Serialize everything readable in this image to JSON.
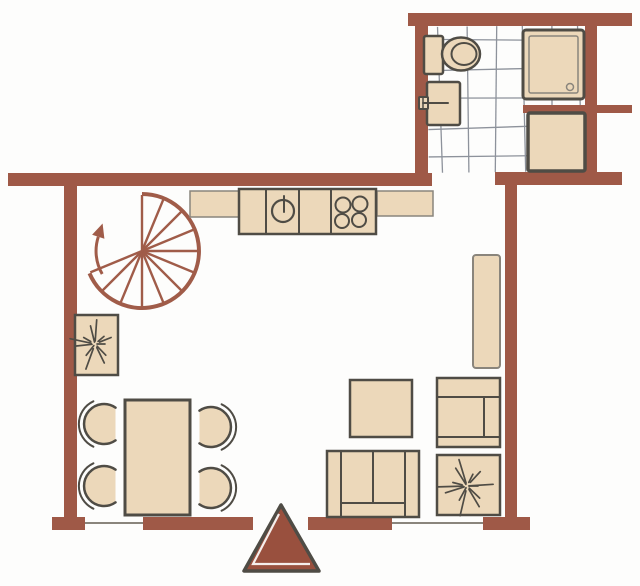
{
  "meta": {
    "title": "apartment-floor-plan",
    "canvas": {
      "width": 640,
      "height": 586
    }
  },
  "palette": {
    "background": "#fdfdfc",
    "wall": "#9f5947",
    "stair": "#a05c49",
    "furniture_fill": "#ecd8ba",
    "outline_dark": "#4f4c45",
    "outline_soft": "#8a857c",
    "grid": "#8d929b",
    "triangle_fill": "#99503e",
    "white": "#ffffff"
  },
  "tile_grid": {
    "region": {
      "x": 428,
      "y": 26,
      "w": 157,
      "h": 146
    },
    "vertical_lines": [
      440,
      468,
      496,
      524,
      552,
      580
    ],
    "horizontal_lines": [
      40,
      69,
      98,
      127,
      156
    ],
    "tilt_deg": -0.7
  },
  "walls": [
    {
      "name": "bathroom-top-wall",
      "x": 408,
      "y": 13,
      "w": 224,
      "h": 13
    },
    {
      "name": "bathroom-left-wall",
      "x": 415,
      "y": 26,
      "w": 13,
      "h": 147
    },
    {
      "name": "bathroom-right-wall",
      "x": 585,
      "y": 26,
      "w": 12,
      "h": 147
    },
    {
      "name": "bathroom-partition-wall",
      "x": 523,
      "y": 105,
      "w": 109,
      "h": 8
    },
    {
      "name": "main-top-wall",
      "x": 8,
      "y": 173,
      "w": 424,
      "h": 13
    },
    {
      "name": "bathroom-bottom-wall",
      "x": 495,
      "y": 172,
      "w": 127,
      "h": 13
    },
    {
      "name": "left-wall",
      "x": 64,
      "y": 186,
      "w": 13,
      "h": 344
    },
    {
      "name": "right-wall",
      "x": 505,
      "y": 185,
      "w": 12,
      "h": 333
    },
    {
      "name": "bottom-wall-left-corner",
      "x": 52,
      "y": 517,
      "w": 33,
      "h": 13
    },
    {
      "name": "bottom-wall-left",
      "x": 143,
      "y": 517,
      "w": 110,
      "h": 13
    },
    {
      "name": "bottom-wall-right",
      "x": 308,
      "y": 517,
      "w": 84,
      "h": 13
    },
    {
      "name": "bottom-wall-right-corner",
      "x": 483,
      "y": 517,
      "w": 47,
      "h": 13
    }
  ],
  "windows": [
    {
      "name": "window-left",
      "x1": 85,
      "y1": 523,
      "x2": 143,
      "y2": 523
    },
    {
      "name": "window-right",
      "x1": 392,
      "y1": 523,
      "x2": 483,
      "y2": 523
    }
  ],
  "stair": {
    "name": "spiral-staircase",
    "cx": 142,
    "cy": 251,
    "r_outer": 57,
    "r_inner": 46,
    "outer_arc": {
      "start_deg": -90,
      "end_deg": 157
    },
    "inner_arc": {
      "start_deg": 150,
      "end_deg": 198
    },
    "spokes": {
      "start_deg": -90,
      "step_deg": 22.5,
      "count": 12
    },
    "arrow": {
      "len": 14,
      "half_width": 6.5
    }
  },
  "shapes": [
    {
      "type": "rect",
      "name": "toilet-tank",
      "x": 424,
      "y": 36,
      "w": 19,
      "h": 38,
      "rx": 2,
      "fill": "furniture_fill",
      "stroke": "outline_dark",
      "sw": 2.5
    },
    {
      "type": "ellipse",
      "name": "toilet-bowl",
      "cx": 461,
      "cy": 54,
      "rx": 19,
      "ry": 16.5,
      "fill": "furniture_fill",
      "stroke": "outline_dark",
      "sw": 2.5
    },
    {
      "type": "ellipse",
      "name": "toilet-bowl-inner",
      "cx": 464,
      "cy": 54,
      "rx": 12.5,
      "ry": 11,
      "fill": "none",
      "stroke": "outline_dark",
      "sw": 2
    },
    {
      "type": "rect",
      "name": "bathroom-sink",
      "x": 427,
      "y": 82,
      "w": 33,
      "h": 43,
      "rx": 2,
      "fill": "furniture_fill",
      "stroke": "outline_dark",
      "sw": 2.5
    },
    {
      "type": "rect",
      "name": "sink-tap-handle",
      "x": 419,
      "y": 97,
      "w": 9,
      "h": 12,
      "rx": 1,
      "fill": "furniture_fill",
      "stroke": "outline_dark",
      "sw": 2
    },
    {
      "type": "line",
      "name": "sink-tap-spout",
      "x1": 423,
      "y1": 103,
      "x2": 448,
      "y2": 103,
      "stroke": "outline_dark",
      "sw": 2
    },
    {
      "type": "line",
      "name": "sink-tap-cross",
      "x1": 423,
      "y1": 97,
      "x2": 423,
      "y2": 109,
      "stroke": "outline_dark",
      "sw": 1.5
    },
    {
      "type": "rect",
      "name": "shower-tray",
      "x": 523,
      "y": 30,
      "w": 61,
      "h": 69,
      "rx": 3,
      "fill": "furniture_fill",
      "stroke": "outline_dark",
      "sw": 3
    },
    {
      "type": "rect",
      "name": "shower-tray-inner",
      "x": 529,
      "y": 36,
      "w": 49,
      "h": 57,
      "rx": 2,
      "fill": "none",
      "stroke": "outline_soft",
      "sw": 1.5
    },
    {
      "type": "circle",
      "name": "shower-drain",
      "cx": 570,
      "cy": 87,
      "r": 3.5,
      "fill": "none",
      "stroke": "outline_soft",
      "sw": 1.5
    },
    {
      "type": "rect",
      "name": "washing-machine",
      "x": 528,
      "y": 113,
      "w": 57,
      "h": 58,
      "rx": 2,
      "fill": "furniture_fill",
      "stroke": "outline_dark",
      "sw": 3.5
    },
    {
      "type": "rect",
      "name": "kitchen-counter-left",
      "x": 190,
      "y": 191,
      "w": 50,
      "h": 26,
      "fill": "furniture_fill",
      "stroke": "outline_soft",
      "sw": 1.5
    },
    {
      "type": "rect",
      "name": "kitchen-counter-right",
      "x": 377,
      "y": 191,
      "w": 56,
      "h": 25,
      "fill": "furniture_fill",
      "stroke": "outline_soft",
      "sw": 1.5
    },
    {
      "type": "rect",
      "name": "kitchen-counter-main",
      "x": 239,
      "y": 189,
      "w": 137,
      "h": 45,
      "fill": "furniture_fill",
      "stroke": "outline_dark",
      "sw": 2.5
    },
    {
      "type": "line",
      "name": "counter-divider-1",
      "x1": 266,
      "y1": 189,
      "x2": 266,
      "y2": 234,
      "stroke": "outline_dark",
      "sw": 2
    },
    {
      "type": "line",
      "name": "counter-divider-2",
      "x1": 299,
      "y1": 189,
      "x2": 299,
      "y2": 234,
      "stroke": "outline_dark",
      "sw": 2
    },
    {
      "type": "line",
      "name": "counter-divider-3",
      "x1": 331,
      "y1": 189,
      "x2": 331,
      "y2": 234,
      "stroke": "outline_dark",
      "sw": 2
    },
    {
      "type": "circle",
      "name": "kitchen-sink-basin",
      "cx": 283,
      "cy": 211,
      "r": 11,
      "fill": "none",
      "stroke": "outline_dark",
      "sw": 2.2
    },
    {
      "type": "line",
      "name": "kitchen-sink-tap",
      "x1": 284,
      "y1": 196,
      "x2": 284,
      "y2": 212,
      "stroke": "outline_dark",
      "sw": 2
    },
    {
      "type": "circle",
      "name": "hob-burner-1",
      "cx": 343,
      "cy": 205,
      "r": 7.5,
      "fill": "none",
      "stroke": "outline_dark",
      "sw": 2
    },
    {
      "type": "circle",
      "name": "hob-burner-2",
      "cx": 360,
      "cy": 204,
      "r": 7.5,
      "fill": "none",
      "stroke": "outline_dark",
      "sw": 2
    },
    {
      "type": "circle",
      "name": "hob-burner-3",
      "cx": 342,
      "cy": 221,
      "r": 7,
      "fill": "none",
      "stroke": "outline_dark",
      "sw": 2
    },
    {
      "type": "circle",
      "name": "hob-burner-4",
      "cx": 359,
      "cy": 220,
      "r": 7,
      "fill": "none",
      "stroke": "outline_dark",
      "sw": 2
    },
    {
      "type": "rect",
      "name": "wall-shelf",
      "x": 473,
      "y": 255,
      "w": 27,
      "h": 113,
      "rx": 3,
      "fill": "furniture_fill",
      "stroke": "outline_soft",
      "sw": 2
    },
    {
      "type": "rect",
      "name": "coffee-table",
      "x": 350,
      "y": 380,
      "w": 62,
      "h": 57,
      "fill": "furniture_fill",
      "stroke": "outline_dark",
      "sw": 2.5
    },
    {
      "type": "rect",
      "name": "sofa",
      "x": 327,
      "y": 451,
      "w": 92,
      "h": 66,
      "fill": "furniture_fill",
      "stroke": "outline_dark",
      "sw": 2.5
    },
    {
      "type": "line",
      "name": "sofa-armrest-left",
      "x1": 341,
      "y1": 451,
      "x2": 341,
      "y2": 517,
      "stroke": "outline_dark",
      "sw": 2
    },
    {
      "type": "line",
      "name": "sofa-armrest-right",
      "x1": 405,
      "y1": 451,
      "x2": 405,
      "y2": 517,
      "stroke": "outline_dark",
      "sw": 2
    },
    {
      "type": "line",
      "name": "sofa-cushion-divider",
      "x1": 373,
      "y1": 451,
      "x2": 373,
      "y2": 503,
      "stroke": "outline_dark",
      "sw": 2
    },
    {
      "type": "line",
      "name": "sofa-front-rail",
      "x1": 341,
      "y1": 503,
      "x2": 405,
      "y2": 503,
      "stroke": "outline_dark",
      "sw": 2
    },
    {
      "type": "rect",
      "name": "armchair",
      "x": 437,
      "y": 378,
      "w": 63,
      "h": 69,
      "fill": "furniture_fill",
      "stroke": "outline_dark",
      "sw": 2.5
    },
    {
      "type": "line",
      "name": "armchair-back",
      "x1": 437,
      "y1": 397,
      "x2": 500,
      "y2": 397,
      "stroke": "outline_dark",
      "sw": 2
    },
    {
      "type": "line",
      "name": "armchair-armrest",
      "x1": 484,
      "y1": 397,
      "x2": 484,
      "y2": 437,
      "stroke": "outline_dark",
      "sw": 2
    },
    {
      "type": "line",
      "name": "armchair-front-rail",
      "x1": 437,
      "y1": 437,
      "x2": 500,
      "y2": 437,
      "stroke": "outline_dark",
      "sw": 2
    },
    {
      "type": "rect",
      "name": "dining-table",
      "x": 125,
      "y": 400,
      "w": 65,
      "h": 115,
      "fill": "furniture_fill",
      "stroke": "outline_dark",
      "sw": 3,
      "after_chairs": true
    }
  ],
  "chairs": [
    {
      "name": "dining-chair-top-left",
      "cx": 104,
      "cy": 424,
      "r": 20,
      "facing": "right"
    },
    {
      "name": "dining-chair-bottom-left",
      "cx": 104,
      "cy": 486,
      "r": 20,
      "facing": "right"
    },
    {
      "name": "dining-chair-top-right",
      "cx": 211,
      "cy": 427,
      "r": 20,
      "facing": "left"
    },
    {
      "name": "dining-chair-bottom-right",
      "cx": 211,
      "cy": 488,
      "r": 20,
      "facing": "left"
    }
  ],
  "plants": [
    {
      "name": "potted-plant-left",
      "pot": {
        "x": 75,
        "y": 315,
        "w": 43,
        "h": 60
      },
      "star": {
        "cx": 95,
        "cy": 344,
        "spikes": 12,
        "rmin": 10,
        "rmax": 28
      }
    },
    {
      "name": "potted-plant-right",
      "pot": {
        "x": 437,
        "y": 455,
        "w": 63,
        "h": 60
      },
      "star": {
        "cx": 467,
        "cy": 486,
        "spikes": 13,
        "rmin": 11,
        "rmax": 32
      }
    }
  ],
  "entrance": {
    "name": "entrance-direction-triangle",
    "points": [
      [
        281,
        505
      ],
      [
        244,
        571
      ],
      [
        319,
        571
      ]
    ],
    "highlight": [
      [
        279,
        514
      ],
      [
        253,
        564
      ],
      [
        310,
        564
      ]
    ]
  }
}
